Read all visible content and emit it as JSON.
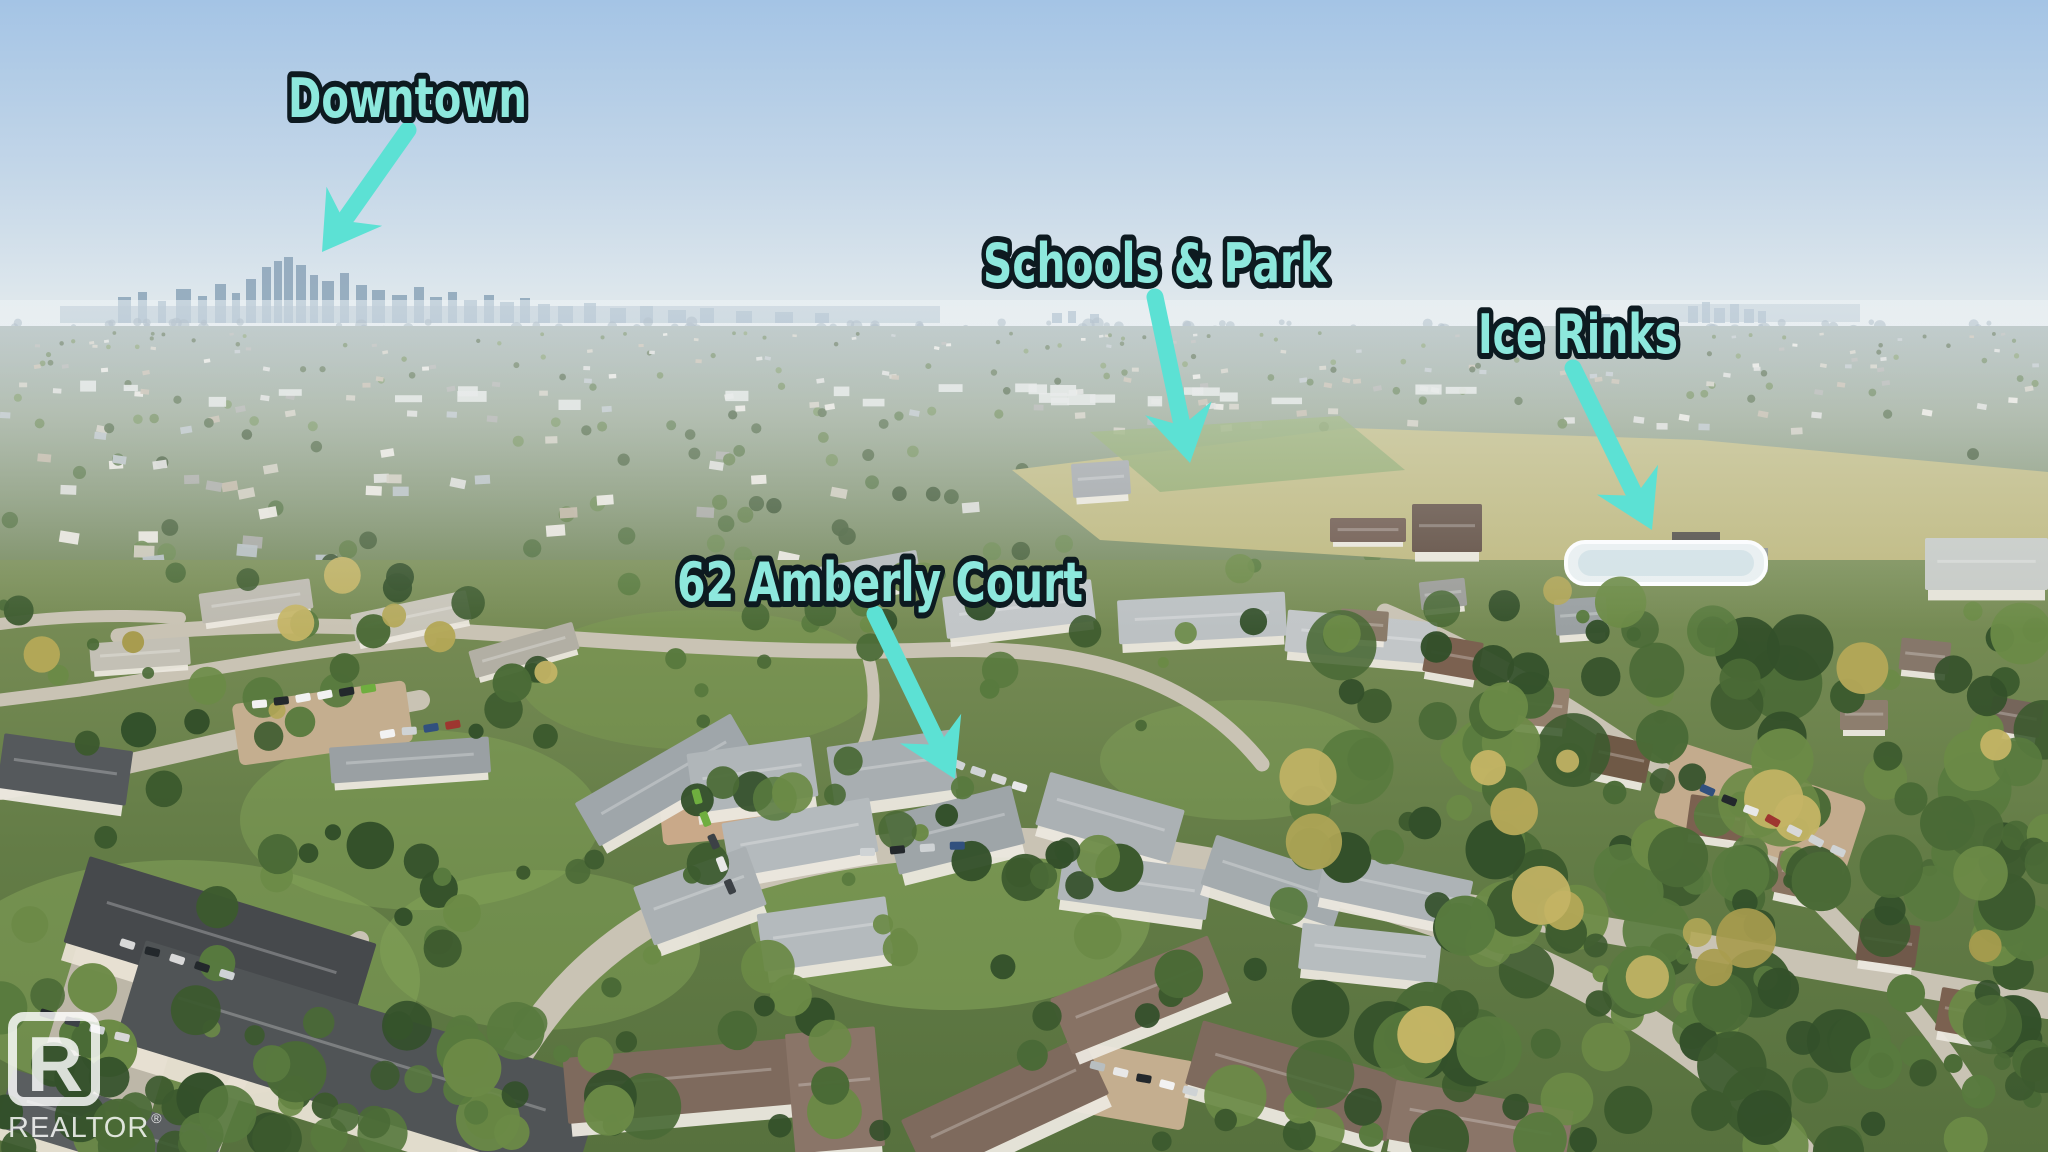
{
  "image": {
    "description": "Aerial drone photo of a suburban neighbourhood on a clear day with labelled points of interest and a distant downtown skyline",
    "width": 2048,
    "height": 1152
  },
  "annotations": {
    "downtown": {
      "label": "Downtown"
    },
    "schools_park": {
      "label": "Schools & Park"
    },
    "ice_rinks": {
      "label": "Ice Rinks"
    },
    "property": {
      "label": "62 Amberly Court"
    }
  },
  "icons": {
    "downtown_arrow": "arrow-down-left",
    "schools_park_arrow": "arrow-down",
    "ice_rinks_arrow": "arrow-down-right",
    "property_arrow": "arrow-down-right"
  },
  "style": {
    "label_fill": "#8de8dd",
    "label_outline": "#0d1a20",
    "arrow_color": "#5ce1d4"
  },
  "watermark": {
    "logo_letter": "R",
    "brand": "REALTOR",
    "registered": "®"
  }
}
